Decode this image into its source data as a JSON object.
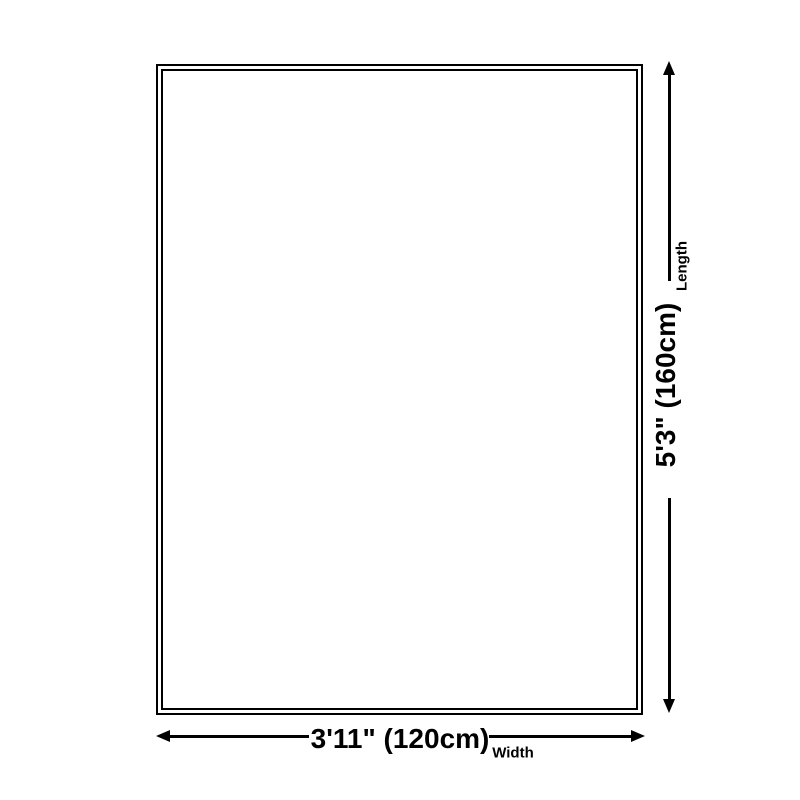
{
  "colors": {
    "line": "#000000",
    "background": "#ffffff"
  },
  "dimensions": {
    "length": {
      "value": "5'3\" (160cm)",
      "label": "Length"
    },
    "width": {
      "value": "3'11\" (120cm)",
      "label": "Width"
    }
  }
}
